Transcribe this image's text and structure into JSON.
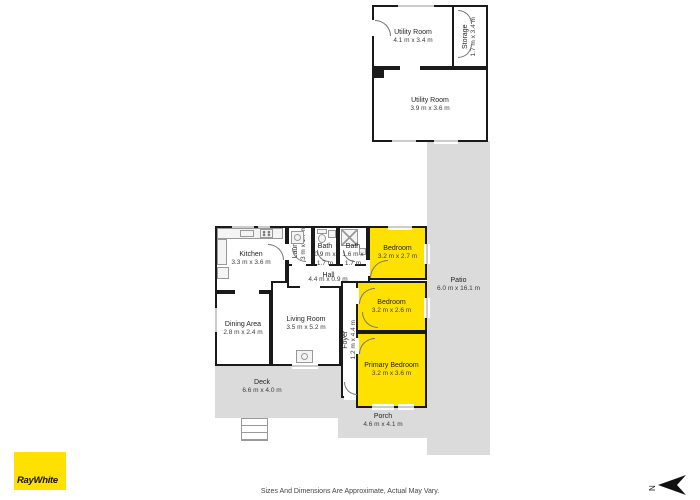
{
  "meta": {
    "title": "RayWhite property floor plan"
  },
  "branding": {
    "logo_text": "RayWhite"
  },
  "footer": {
    "disclaimer": "Sizes And Dimensions Are Approximate, Actual May Vary."
  },
  "compass": {
    "north_label": "N"
  },
  "colors": {
    "highlight_yellow": "#ffe100",
    "outdoor_gray": "#dbdbdb",
    "wall_black": "#1a1a1a",
    "background": "#ffffff"
  },
  "rooms": {
    "utility_a": {
      "name": "Utility Room",
      "dims": "4.1 m x 3.4 m"
    },
    "storage": {
      "name": "Storage",
      "dims": "1.7 m x 3.4 m"
    },
    "utility_b": {
      "name": "Utility Room",
      "dims": "3.9 m x 3.6 m"
    },
    "kitchen": {
      "name": "Kitchen",
      "dims": "3.3 m x 3.6 m"
    },
    "laundry": {
      "name": "Laundry",
      "dims": "1.3 m x 1.7 m"
    },
    "bath_small": {
      "name": "Bath",
      "dims": "0.9 m x 1.7 m"
    },
    "bath_large": {
      "name": "Bath",
      "dims": "1.6 m x 1.7 m"
    },
    "hall": {
      "name": "Hall",
      "dims": "4.4 m x 0.9 m"
    },
    "bedroom_1": {
      "name": "Bedroom",
      "dims": "3.2 m x 2.7 m"
    },
    "bedroom_2": {
      "name": "Bedroom",
      "dims": "3.2 m x 2.6 m"
    },
    "foyer": {
      "name": "Foyer",
      "dims": "1.2 m x 4.4 m"
    },
    "primary": {
      "name": "Primary Bedroom",
      "dims": "3.2 m x 3.6 m"
    },
    "dining": {
      "name": "Dining Area",
      "dims": "2.8 m x 2.4 m"
    },
    "living": {
      "name": "Living Room",
      "dims": "3.5 m x 5.2 m"
    },
    "deck": {
      "name": "Deck",
      "dims": "6.6 m x 4.0 m"
    },
    "porch": {
      "name": "Porch",
      "dims": "4.6 m x 4.1 m"
    },
    "patio": {
      "name": "Patio",
      "dims": "6.0 m x 16.1 m"
    }
  }
}
